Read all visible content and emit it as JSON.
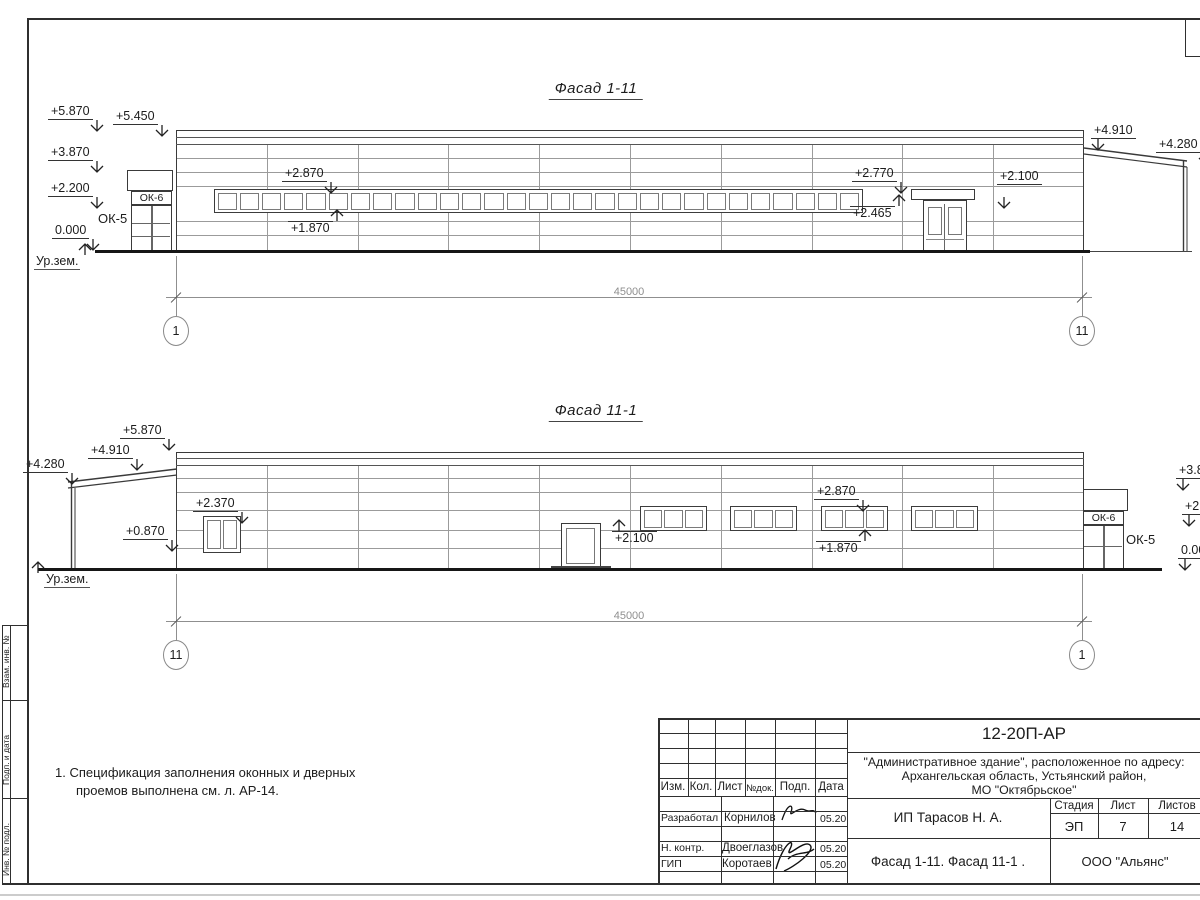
{
  "colors": {
    "line": "#3a3a3a",
    "thin": "#9b9b9b",
    "ground": "#161616",
    "dim": "#8f8f8f",
    "text": "#1c1c1c"
  },
  "note": {
    "lines": [
      "1. Спецификация заполнения оконных и дверных",
      "проемов выполнена см. л. АР-14."
    ]
  },
  "strip": {
    "labels": [
      "Взам. инв. №",
      "Подп. и дата",
      "Инв. № подл."
    ]
  },
  "facades": [
    {
      "title": "Фасад 1-11",
      "dim": "45000",
      "axes": [
        {
          "n": "1",
          "x": 176
        },
        {
          "n": "11",
          "x": 1082
        }
      ],
      "ground_label": {
        "t": "Ур.зем.",
        "x": 34,
        "y": 254,
        "side": "right"
      },
      "ok_band": {
        "t": "ОК-6"
      },
      "ok_label": {
        "t": "ОК-5",
        "x": 98,
        "y": 211
      },
      "marks": [
        {
          "t": "+5.870",
          "x": 48,
          "y": 105,
          "dir": "down",
          "ax": "end"
        },
        {
          "t": "+5.450",
          "x": 113,
          "y": 110,
          "dir": "down",
          "ax": "end"
        },
        {
          "t": "+3.870",
          "x": 48,
          "y": 146,
          "dir": "down",
          "ax": "end"
        },
        {
          "t": "+2.200",
          "x": 48,
          "y": 182,
          "dir": "down",
          "ax": "end"
        },
        {
          "t": "0.000",
          "x": 52,
          "y": 224,
          "dir": "down",
          "ax": "end"
        },
        {
          "t": "+2.870",
          "x": 282,
          "y": 167,
          "dir": "down",
          "ax": "end"
        },
        {
          "t": "+1.870",
          "x": 288,
          "y": 221,
          "dir": "up",
          "ax": "end"
        },
        {
          "t": "+2.770",
          "x": 852,
          "y": 167,
          "dir": "down",
          "ax": "end"
        },
        {
          "t": "+2.465",
          "x": 850,
          "y": 206,
          "dir": "up",
          "ax": "end"
        },
        {
          "t": "+2.100",
          "x": 997,
          "y": 170,
          "dir": "down",
          "ax": "start",
          "gap": 12
        },
        {
          "t": "+4.910",
          "x": 1091,
          "y": 124,
          "dir": "down",
          "ax": "start"
        },
        {
          "t": "+4.280",
          "x": 1156,
          "y": 138,
          "dir": "down",
          "ax": "end"
        }
      ]
    },
    {
      "title": "Фасад 11-1",
      "dim": "45000",
      "axes": [
        {
          "n": "11",
          "x": 176
        },
        {
          "n": "1",
          "x": 1082
        }
      ],
      "ground_label": {
        "t": "Ур.зем.",
        "x": 44,
        "y": 572,
        "side": "left"
      },
      "ok_band": {
        "t": "ОК-6"
      },
      "ok_label": {
        "t": "ОК-5",
        "x": 1126,
        "y": 532
      },
      "marks": [
        {
          "t": "+5.870",
          "x": 120,
          "y": 424,
          "dir": "down",
          "ax": "end"
        },
        {
          "t": "+4.910",
          "x": 88,
          "y": 444,
          "dir": "down",
          "ax": "end"
        },
        {
          "t": "+4.280",
          "x": 23,
          "y": 458,
          "dir": "down",
          "ax": "end"
        },
        {
          "t": "+2.370",
          "x": 193,
          "y": 497,
          "dir": "down",
          "ax": "end"
        },
        {
          "t": "+0.870",
          "x": 123,
          "y": 525,
          "dir": "down",
          "ax": "end"
        },
        {
          "t": "+2.100",
          "x": 612,
          "y": 531,
          "dir": "up",
          "ax": "start"
        },
        {
          "t": "+2.870",
          "x": 814,
          "y": 485,
          "dir": "down",
          "ax": "end"
        },
        {
          "t": "+1.870",
          "x": 816,
          "y": 541,
          "dir": "up",
          "ax": "end"
        },
        {
          "t": "+3.870",
          "x": 1176,
          "y": 464,
          "dir": "down",
          "ax": "start"
        },
        {
          "t": "+2.200",
          "x": 1182,
          "y": 500,
          "dir": "down",
          "ax": "start"
        },
        {
          "t": "0.000",
          "x": 1178,
          "y": 544,
          "dir": "down",
          "ax": "start"
        }
      ]
    }
  ],
  "titleblock": {
    "doc_number": "12-20П-АР",
    "project_lines": [
      "\"Административное здание\", расположенное по адресу:",
      "Архангельская область, Устьянский район,",
      "МО \"Октябрьское\""
    ],
    "client": "ИП Тарасов Н. А.",
    "sheet_title": "Фасад 1-11. Фасад 11-1 .",
    "company": "ООО \"Альянс\"",
    "cols": [
      "Изм.",
      "Кол.",
      "Лист",
      "№док.",
      "Подп.",
      "Дата"
    ],
    "stage_header": [
      "Стадия",
      "Лист",
      "Листов"
    ],
    "stage_values": [
      "ЭП",
      "7",
      "14"
    ],
    "rows": [
      {
        "role": "Разработал",
        "name": "Корнилов",
        "date": "05.20"
      },
      {
        "role": "Н. контр.",
        "name": "Двоеглазов",
        "date": "05.20"
      },
      {
        "role": "ГИП",
        "name": "Коротаев",
        "date": "05.20"
      }
    ]
  }
}
